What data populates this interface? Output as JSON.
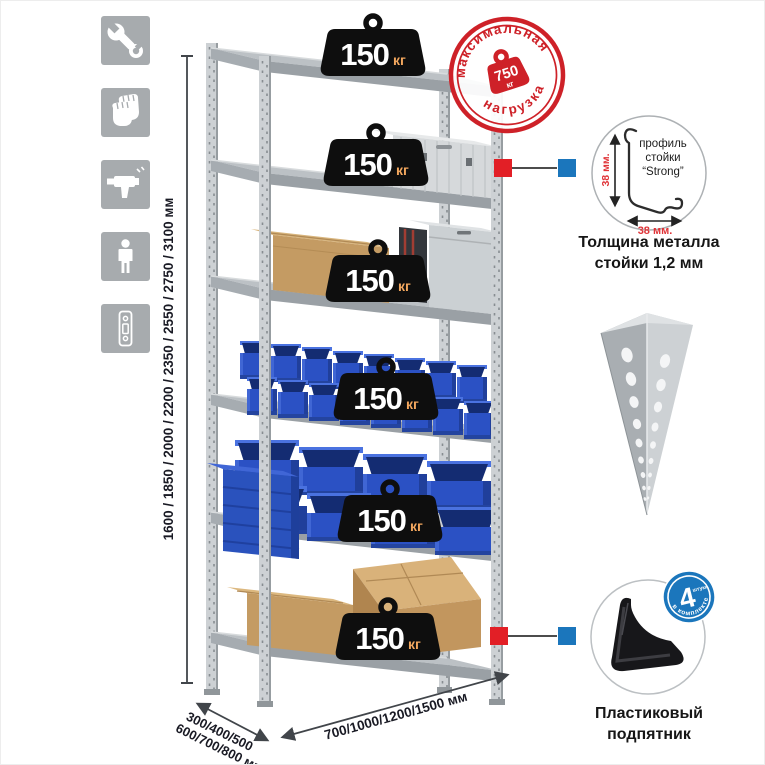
{
  "rack": {
    "weights": [
      {
        "value": "150",
        "unit": "кг"
      },
      {
        "value": "150",
        "unit": "кг"
      },
      {
        "value": "150",
        "unit": "кг"
      },
      {
        "value": "150",
        "unit": "кг"
      },
      {
        "value": "150",
        "unit": "кг"
      },
      {
        "value": "150",
        "unit": "кг"
      }
    ],
    "dimensions": {
      "heights": "1600 / 1850 / 2000 / 2200 / 2350 / 2550 / 2750 / 3100 мм",
      "depths_line1": "300/400/500",
      "depths_line2": "600/700/800 мм",
      "widths": "700/1000/1200/1500 мм"
    }
  },
  "stamp": {
    "top": "максимальная",
    "bottom": "нагрузка",
    "value": "750",
    "unit": "кг"
  },
  "profile_detail": {
    "dim_vertical": "38 мм.",
    "dim_horizontal": "38 мм.",
    "label1": "профиль",
    "label2": "стойки",
    "label3": "“Strong”",
    "caption1": "Толщина металла",
    "caption2": "стойки 1,2 мм"
  },
  "foot_detail": {
    "badge_number": "4",
    "badge_word": "штуки",
    "badge_arc": "в комплекте",
    "caption1": "Пластиковый",
    "caption2": "подпятник"
  },
  "sidebar": {
    "icons": [
      {
        "name": "wrench-icon"
      },
      {
        "name": "gloves-icon"
      },
      {
        "name": "drill-icon"
      },
      {
        "name": "person-icon"
      },
      {
        "name": "upright-profile-icon"
      }
    ]
  },
  "colors": {
    "accent_red": "#ce2128",
    "accent_blue": "#1b76bc",
    "metal_gray": "#b7bcc0",
    "bin_blue": "#2b51c4",
    "cardboard": "#c49b63",
    "icon_bg": "#a7abae"
  }
}
